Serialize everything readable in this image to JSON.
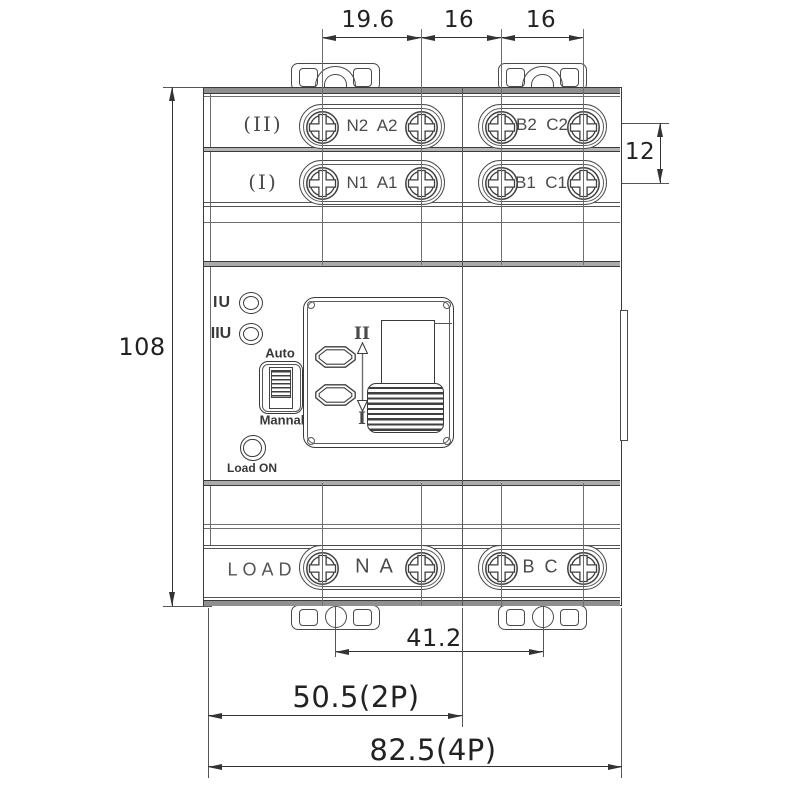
{
  "figure": {
    "type": "technical-drawing",
    "subject": "Dual-power automatic transfer switch, front view with dimensions (mm)"
  },
  "dims": {
    "top": [
      "19.6",
      "16",
      "16"
    ],
    "right": "12",
    "left": "108",
    "bottom_pitch": "41.2",
    "bottom_2p": "50.5(2P)",
    "bottom_4p": "82.5(4P)"
  },
  "terminals": {
    "row2": {
      "label": "(II)",
      "g1": "N2  A2",
      "g2": "B2  C2"
    },
    "row1": {
      "label": "(I)",
      "g1": "N1  A1",
      "g2": "B1  C1"
    },
    "load": {
      "label": "LOAD",
      "g1": "N  A",
      "g2": "B  C"
    }
  },
  "panel": {
    "led1": "IU",
    "led2": "IIU",
    "mode_top": "Auto",
    "mode_bottom": "Mannal",
    "load_on": "Load ON",
    "pos_top": "II",
    "pos_bottom": "I"
  },
  "colors": {
    "line": "#3a3a3a",
    "light_line": "#6e6e6e",
    "cap_fill": "#8f8f8f",
    "divider_fill": "#b5b5b5",
    "text": "#222222"
  }
}
